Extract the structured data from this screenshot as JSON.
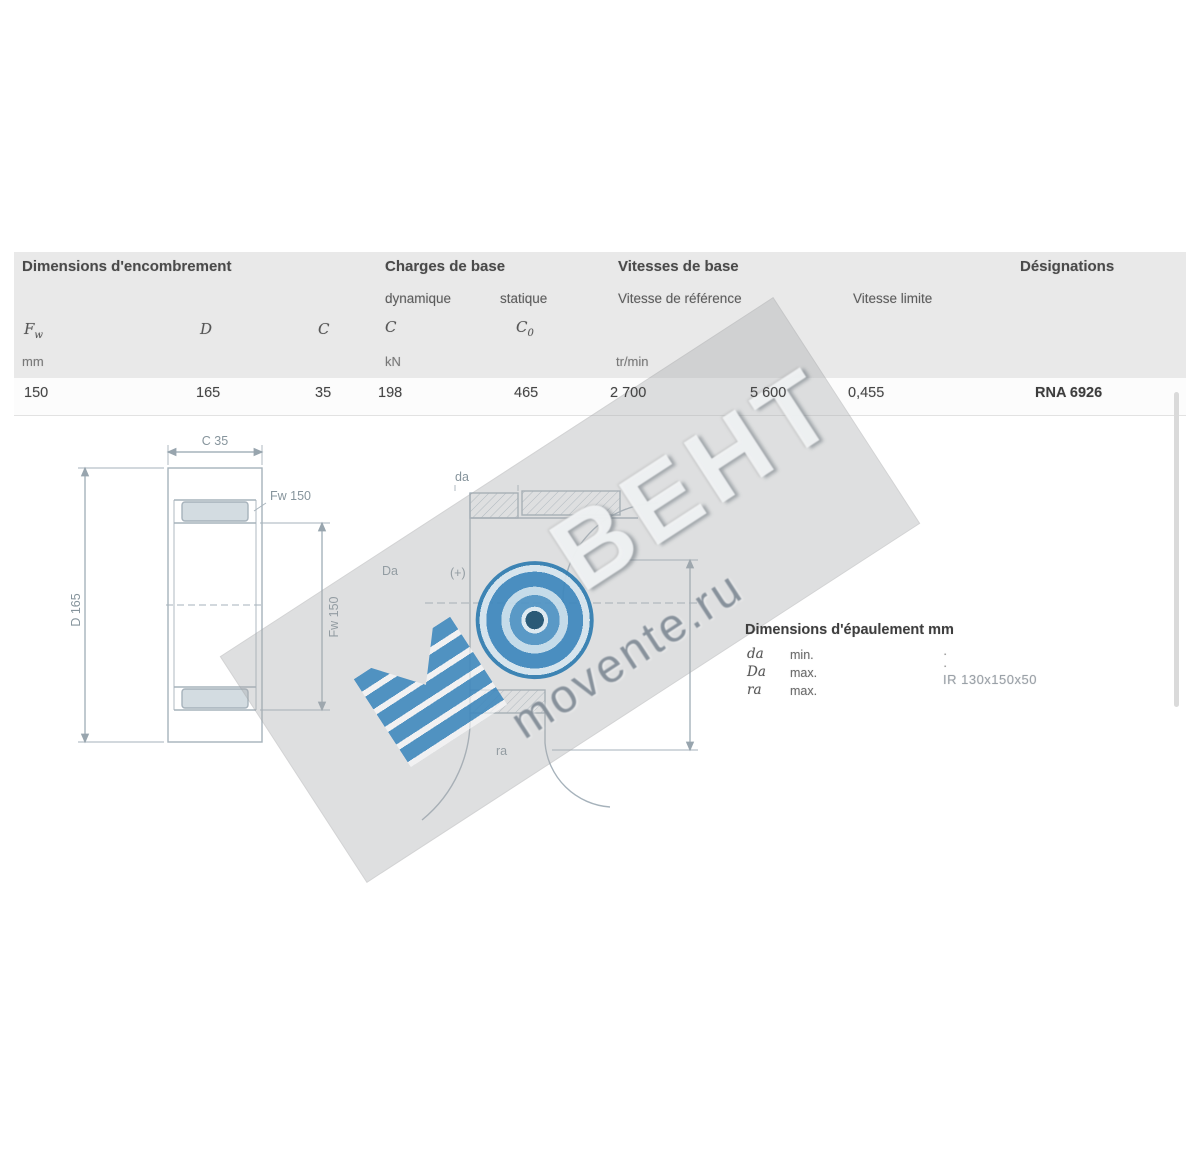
{
  "table": {
    "groups": {
      "dims": "Dimensions d'encombrement",
      "loads": "Charges de base",
      "speeds": "Vitesses de base",
      "designations": "Désignations"
    },
    "subs": {
      "dynamic": "dynamique",
      "static": "statique",
      "ref": "Vitesse de référence",
      "limit": "Vitesse limite"
    },
    "symbols": {
      "fw": [
        "F",
        "w"
      ],
      "d": [
        "D",
        ""
      ],
      "c": [
        "C",
        ""
      ],
      "cdyn": [
        "C",
        ""
      ],
      "cstat": [
        "C",
        "0"
      ]
    },
    "units": {
      "dim": "mm",
      "load": "kN",
      "speed": "tr/min"
    },
    "row": {
      "fw": "150",
      "d": "165",
      "c": "35",
      "cdyn": "198",
      "cstat": "465",
      "vref": "2 700",
      "vlimit": "5 600",
      "mass": "0,455",
      "designation": "RNA 6926"
    }
  },
  "drawing_left": {
    "dim_top": "C 35",
    "dim_left": "D 165",
    "dim_right": "Fw 150",
    "note": "Fw 150"
  },
  "drawing_right": {
    "top": "da",
    "left": "Da",
    "datum": "(+)",
    "bottom": "ra"
  },
  "details": {
    "heading": "Dimensions d'épaulement mm",
    "rows": [
      {
        "sym": "da",
        "qual": "min.",
        "val": "·"
      },
      {
        "sym": "Da",
        "qual": "max.",
        "val": "·"
      },
      {
        "sym": "ra",
        "qual": "max.",
        "val": ""
      }
    ],
    "related": "IR 130x150x50"
  },
  "watermark": {
    "m": "М",
    "letters": "ВЕНТ",
    "domain": "movente.ru"
  }
}
